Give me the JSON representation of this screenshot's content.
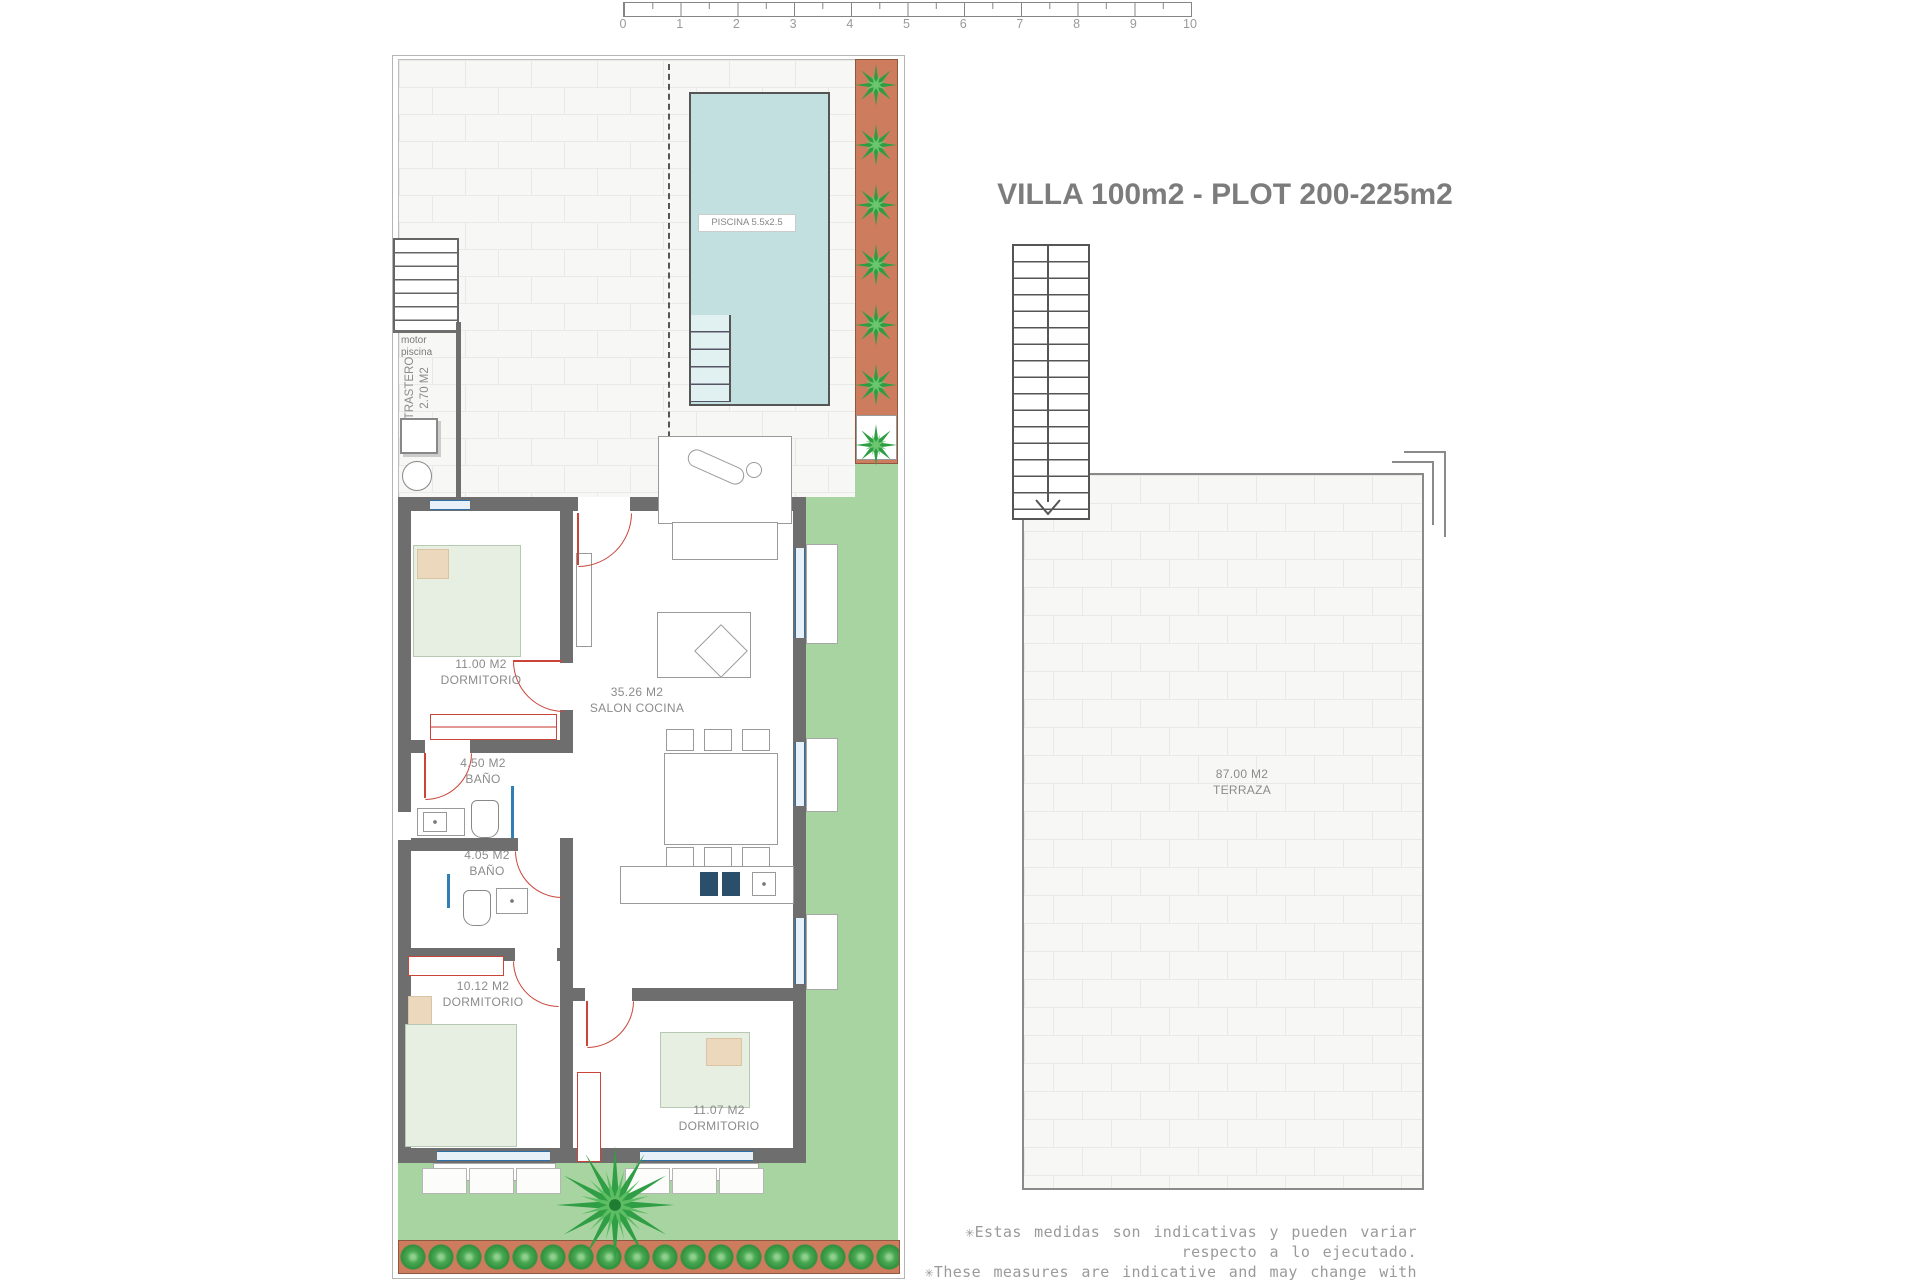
{
  "title": "VILLA 100m2 - PLOT 200-225m2",
  "scale_bar": {
    "ticks": [
      "0",
      "1",
      "2",
      "3",
      "4",
      "5",
      "6",
      "7",
      "8",
      "9",
      "10"
    ]
  },
  "villa": {
    "pool_label": "PISCINA 5.5x2.5",
    "storage": {
      "motor_line1": "motor",
      "motor_line2": "piscina",
      "name": "TRASTERO",
      "area": "2.70 M2"
    },
    "rooms": [
      {
        "area": "11.00 M2",
        "name": "DORMITORIO"
      },
      {
        "area": "35.26 M2",
        "name": "SALON COCINA"
      },
      {
        "area": "4.50 M2",
        "name": "BAÑO"
      },
      {
        "area": "4.05 M2",
        "name": "BAÑO"
      },
      {
        "area": "10.12 M2",
        "name": "DORMITORIO"
      },
      {
        "area": "11.07 M2",
        "name": "DORMITORIO"
      }
    ]
  },
  "terrace": {
    "area": "87.00 M2",
    "name": "TERRAZA"
  },
  "footnotes": [
    "✳Estas medidas son indicativas y pueden variar respecto a lo ejecutado.",
    "✳These measures are indicative and may change with respect to the execution."
  ],
  "colors": {
    "pool": "#c2e0e0",
    "grass": "#a7d4a0",
    "planter": "#cd7c5e",
    "wall": "#6e6e6e",
    "door": "#c9453a",
    "window": "#2f6fa8"
  }
}
